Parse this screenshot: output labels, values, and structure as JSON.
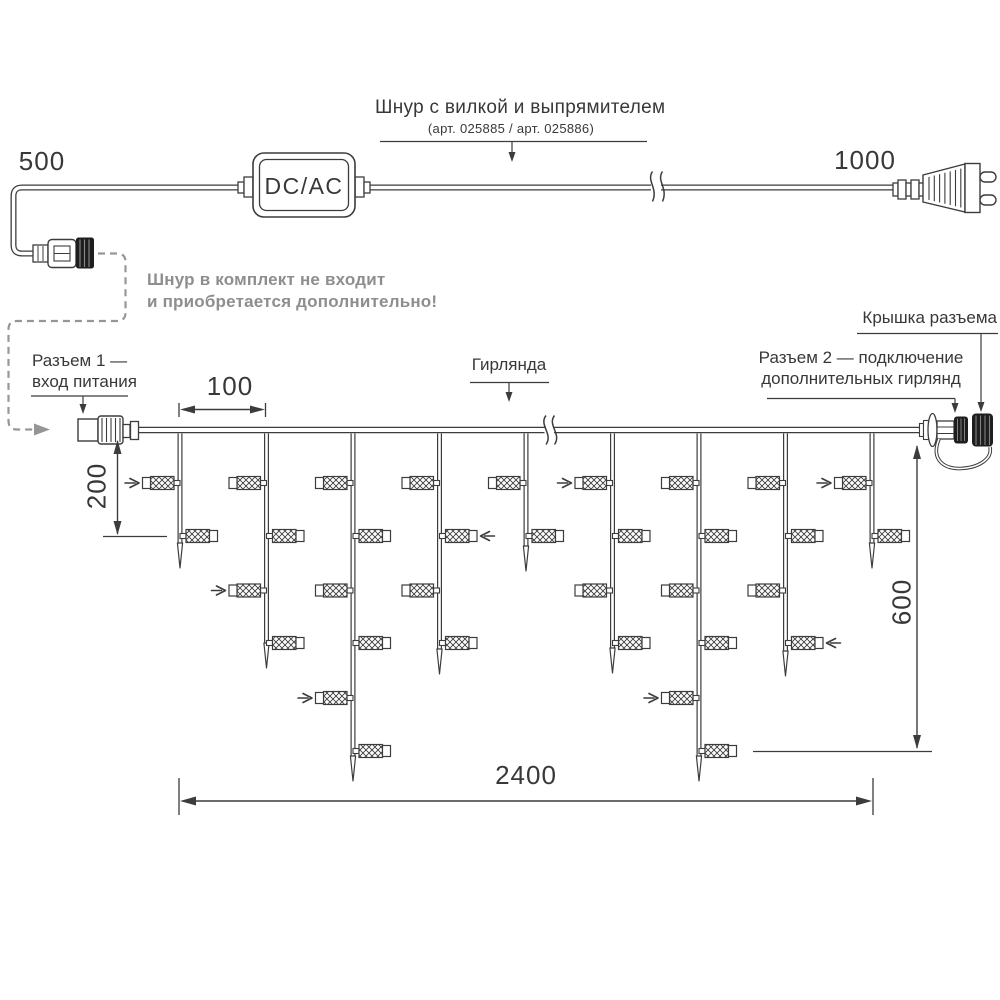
{
  "colors": {
    "line": "#3c3c3c",
    "text": "#383838",
    "gray": "#969696",
    "dark_fill": "#1e1e1e",
    "background": "#ffffff"
  },
  "power_cord": {
    "left_length": "500",
    "right_length": "1000",
    "converter_label": "DC/AC",
    "callout_title": "Шнур с вилкой и выпрямителем",
    "callout_subtitle": "(арт. 025885 /  арт. 025886)",
    "note_line1": "Шнур в комплект не входит",
    "note_line2": "и приобретается дополнительно!"
  },
  "garland": {
    "label": "Гирлянда",
    "connector1_line1": "Разъем 1 —",
    "connector1_line2": "вход питания",
    "connector2_line1": "Разъем 2 — подключение",
    "connector2_line2": "дополнительных гирлянд",
    "cap_label": "Крышка разъема",
    "dimensions": {
      "drop_spacing": "100",
      "first_drop_depth": "200",
      "curtain_height": "600",
      "curtain_length": "2400"
    },
    "geometry": {
      "wire_y": 430,
      "wire_x1": 139,
      "wire_x2": 920,
      "break_x": 549,
      "lamp_levels": [
        483,
        536,
        590.5,
        643,
        698,
        751
      ],
      "drops": [
        {
          "x": 180,
          "tip": 568,
          "lamps": 2,
          "arrow_level": 1
        },
        {
          "x": 266.5,
          "tip": 668,
          "lamps": 4,
          "arrow_level": 3
        },
        {
          "x": 353,
          "tip": 781,
          "lamps": 6,
          "arrow_level": 5
        },
        {
          "x": 439.5,
          "tip": 674,
          "lamps": 4,
          "arrow_level": 2
        },
        {
          "x": 526,
          "tip": 571,
          "lamps": 2,
          "arrow_level": null
        },
        {
          "x": 612.5,
          "tip": 673,
          "lamps": 4,
          "arrow_level": 1
        },
        {
          "x": 699,
          "tip": 781,
          "lamps": 6,
          "arrow_level": 5
        },
        {
          "x": 785.5,
          "tip": 676,
          "lamps": 4,
          "arrow_level": 4
        },
        {
          "x": 872,
          "tip": 568,
          "lamps": 2,
          "arrow_level": 1
        }
      ]
    }
  }
}
